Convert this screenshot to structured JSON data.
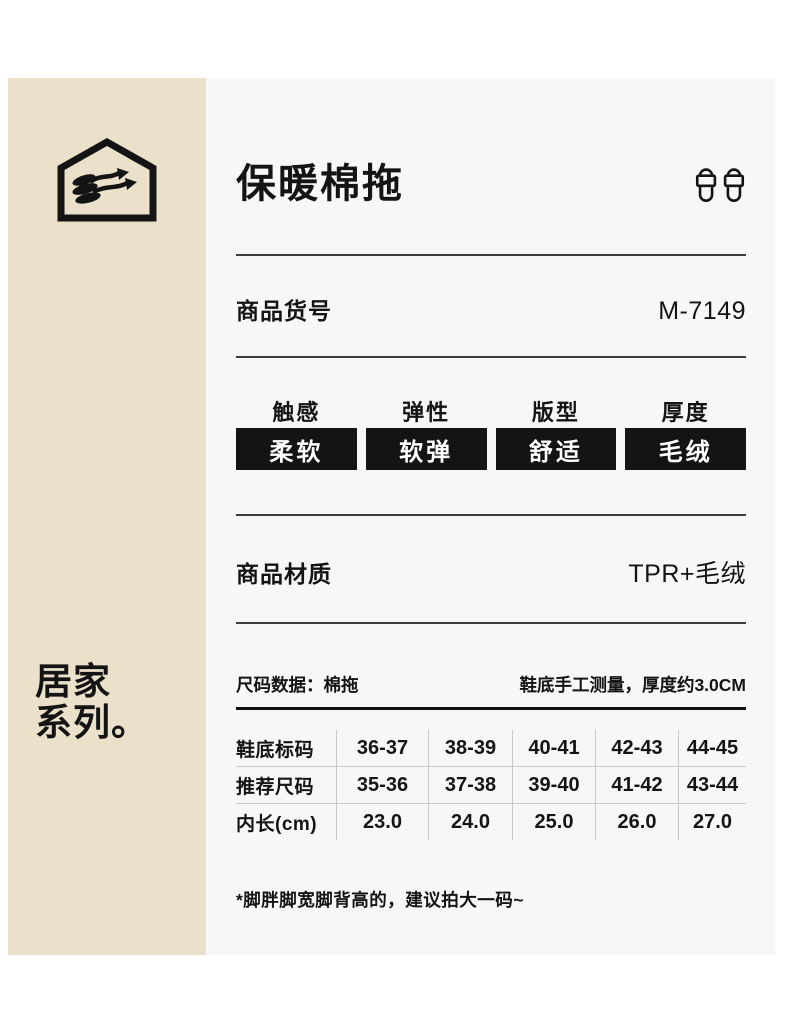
{
  "colors": {
    "sidebar_bg": "#ebe1ca",
    "panel_bg": "#f7f7f7",
    "ink": "#141414",
    "pill_bg": "#141414",
    "pill_text": "#ffffff",
    "divider": "#3c3c3c",
    "table_line": "#c9c9c9",
    "page_bg": "#ffffff"
  },
  "sidebar": {
    "logo_icon": "house-airflow-icon",
    "series_line1": "居家",
    "series_line2": "系列。"
  },
  "header": {
    "title": "保暖棉拖",
    "icon": "slippers-icon"
  },
  "product_number": {
    "label": "商品货号",
    "value": "M-7149"
  },
  "attributes": [
    {
      "label": "触感",
      "value": "柔软"
    },
    {
      "label": "弹性",
      "value": "软弹"
    },
    {
      "label": "版型",
      "value": "舒适"
    },
    {
      "label": "厚度",
      "value": "毛绒"
    }
  ],
  "material": {
    "label": "商品材质",
    "value": "TPR+毛绒"
  },
  "size_section": {
    "heading_left": "尺码数据：棉拖",
    "heading_right": "鞋底手工测量，厚度约3.0CM",
    "table": {
      "rows": [
        {
          "label": "鞋底标码",
          "values": [
            "36-37",
            "38-39",
            "40-41",
            "42-43",
            "44-45"
          ]
        },
        {
          "label": "推荐尺码",
          "values": [
            "35-36",
            "37-38",
            "39-40",
            "41-42",
            "43-44"
          ]
        },
        {
          "label": "内长(cm)",
          "values": [
            "23.0",
            "24.0",
            "25.0",
            "26.0",
            "27.0"
          ]
        }
      ]
    },
    "footnote": "*脚胖脚宽脚背高的，建议拍大一码~"
  }
}
